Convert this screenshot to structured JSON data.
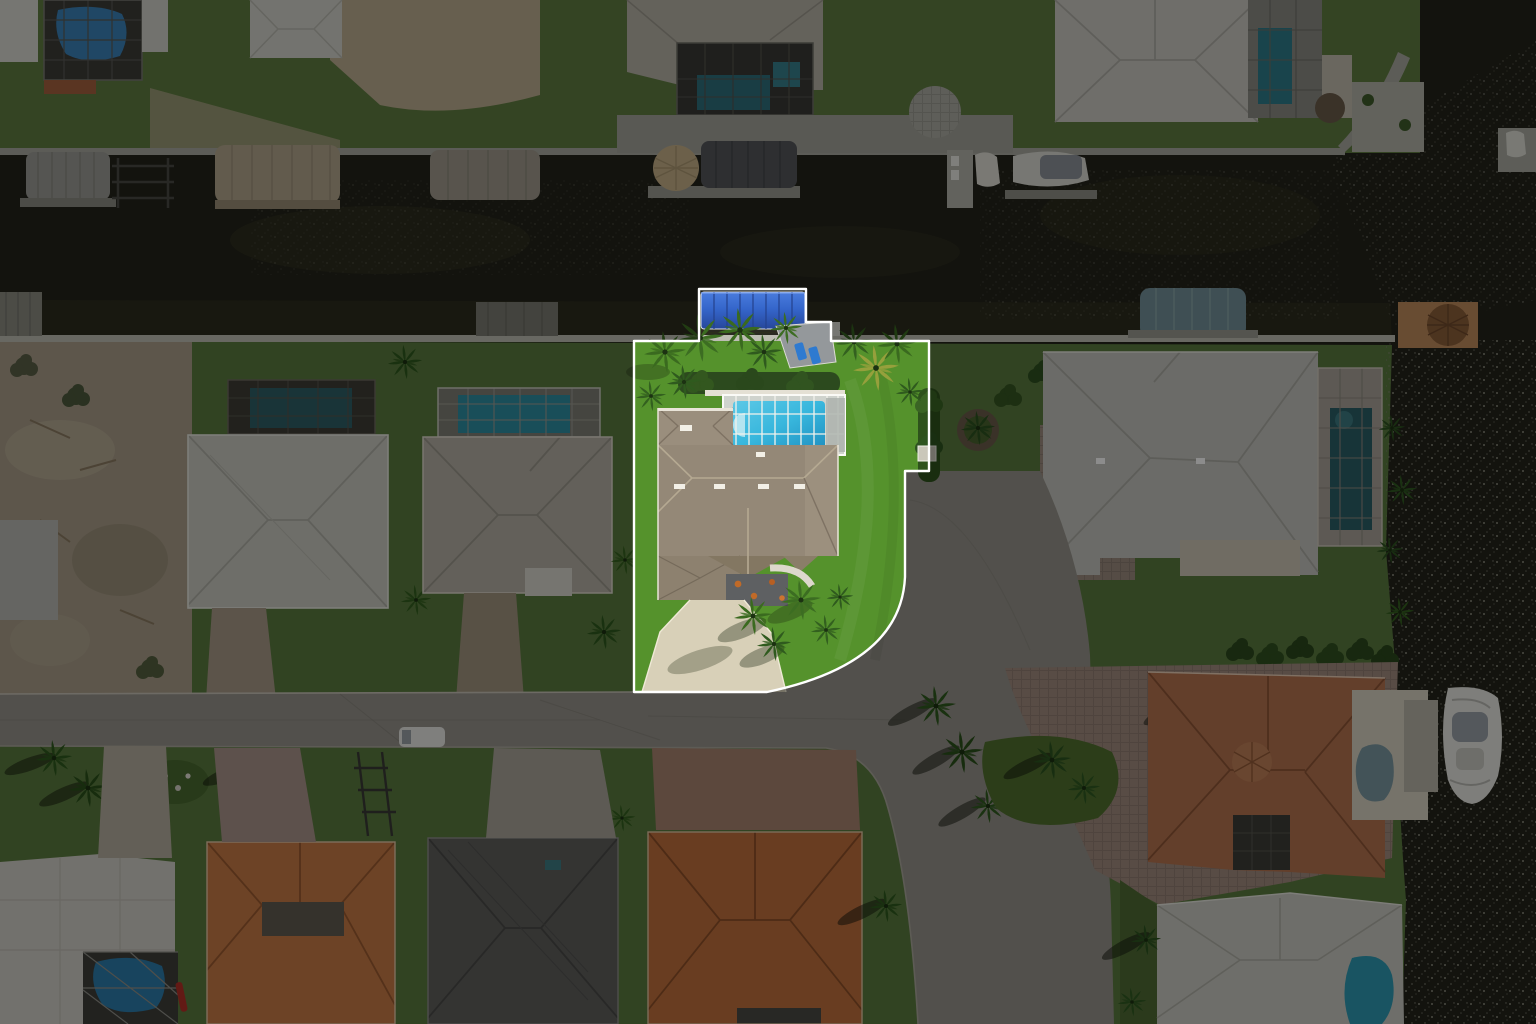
{
  "meta": {
    "image_type": "aerial-drone-photograph",
    "subject": "waterfront-single-family-home-with-highlighted-lot-boundary",
    "view": "top-down",
    "visible_text": "none"
  },
  "highlight": {
    "boundary_path": "M699,289 L806,289 L806,322 L831,322 L831,341 L929,341 L929,471 L905,471 L905,577 Q901,664 767,692 L634,692 L634,341 L699,341 Z",
    "lot_fill_path": "M634,341 L929,341 L929,471 L905,471 L905,577 Q901,664 767,692 L634,692 Z",
    "dim_path": "M0,0 H1536 V1024 H0 Z M699,289 L806,289 L806,322 L831,322 L831,341 L929,341 L929,471 L905,471 L905,577 Q901,664 767,692 L634,692 L634,341 L699,341 Z",
    "stroke_color": "#ffffff",
    "stroke_width": 2.4,
    "dim_color": "#000000",
    "dim_opacity": 0.45
  },
  "palette": {
    "canal_water": "#23231a",
    "water_sparkle": "#8d8c7d",
    "highlight_lawn": "#55922c",
    "neighbor_lawn": "#5a7a3e",
    "asphalt_street": "#95928a",
    "concrete_driveway": "#d8d0b8",
    "subject_roof": "#948877",
    "pool_cyan": "#38b7dd",
    "boat_canopy_blue": "#3566cb",
    "terracotta_roof": "#c0763f",
    "orange_tile_roof": "#c77a45",
    "metal_roof_gray": "#c4c4bd",
    "charcoal_roof": "#5f5f5c",
    "paver_court": "#a18a7e",
    "sand_lot": "#a99d89",
    "seawall": "#bdbdb3",
    "palm_green": "#2f5a1e",
    "hedge_green": "#2c4a1e"
  },
  "scene": {
    "waterways": [
      "canal-east-west",
      "open-water-right"
    ],
    "subject_property": {
      "features": [
        "blue-canopy-boat-lift",
        "concrete-dock",
        "lounge-chairs",
        "hedge-row",
        "screened-pool-enclosure",
        "swimming-pool",
        "tan-shingle-roof-house",
        "entry-courtyard",
        "concrete-driveway",
        "palm-clusters",
        "open-lawn",
        "dock-box"
      ]
    },
    "neighborhood": {
      "north_bank": [
        "screened-pool-homes",
        "boat-lifts",
        "tiki-hut-dock",
        "moored-boats"
      ],
      "west": [
        "vacant-sand-lot",
        "gray-roof-house-with-pool-cage",
        "gray-roof-house-with-blue-pool-cage"
      ],
      "east": [
        "metal-roof-house-with-pool",
        "paver-motor-court",
        "teal-canopy-boat-lift",
        "tiki-dock",
        "white-yacht"
      ],
      "south": [
        "residential-street",
        "curved-road",
        "white-van",
        "boat-trailer",
        "light-roof-house-with-pool-cage",
        "orange-tile-house",
        "charcoal-roof-house",
        "orange-tile-house-2",
        "terracotta-mediterranean-house",
        "gray-roof-house-with-lagoon-pool"
      ]
    }
  }
}
